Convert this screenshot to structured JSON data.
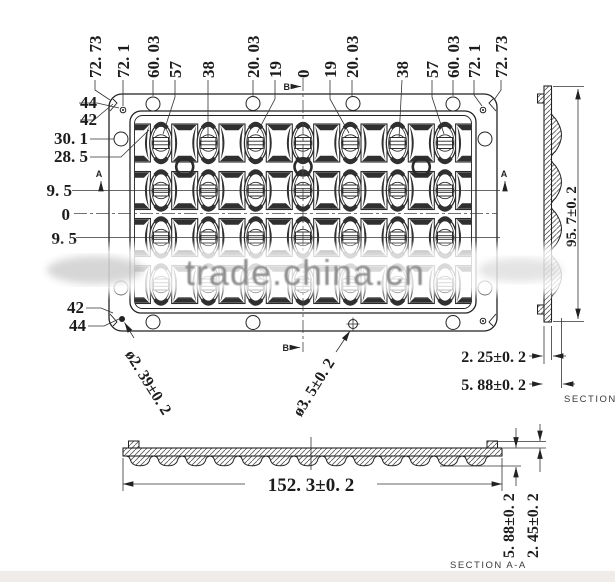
{
  "watermark": {
    "text": "trade.china.cn"
  },
  "top_view": {
    "top_dims": [
      "72. 73",
      "72. 1",
      "60. 03",
      "57",
      "38",
      "20. 03",
      "19",
      "0",
      "19",
      "20. 03",
      "38",
      "57",
      "60. 03",
      "72. 1",
      "72. 73"
    ],
    "left_dims": [
      "44",
      "42",
      "30. 1",
      "28. 5",
      "9. 5",
      "0",
      "9. 5"
    ],
    "bottom_left_dims": [
      "42",
      "44"
    ],
    "corner_hole_dia": "ø2. 39±0. 2",
    "center_hole_dia": "ø3. 5±0. 2",
    "marker_a": "A",
    "marker_b": "B"
  },
  "side_view": {
    "height": "95. 7±0. 2",
    "flat_thickness": "2. 25±0. 2",
    "total_thickness": "5. 88±0. 2",
    "section_label": "SECTION"
  },
  "bottom_view": {
    "width": "152. 3±0. 2",
    "total_thickness": "5. 88±0. 2",
    "flat_thickness": "2. 45±0. 2",
    "section_label": "SECTION A-A"
  }
}
